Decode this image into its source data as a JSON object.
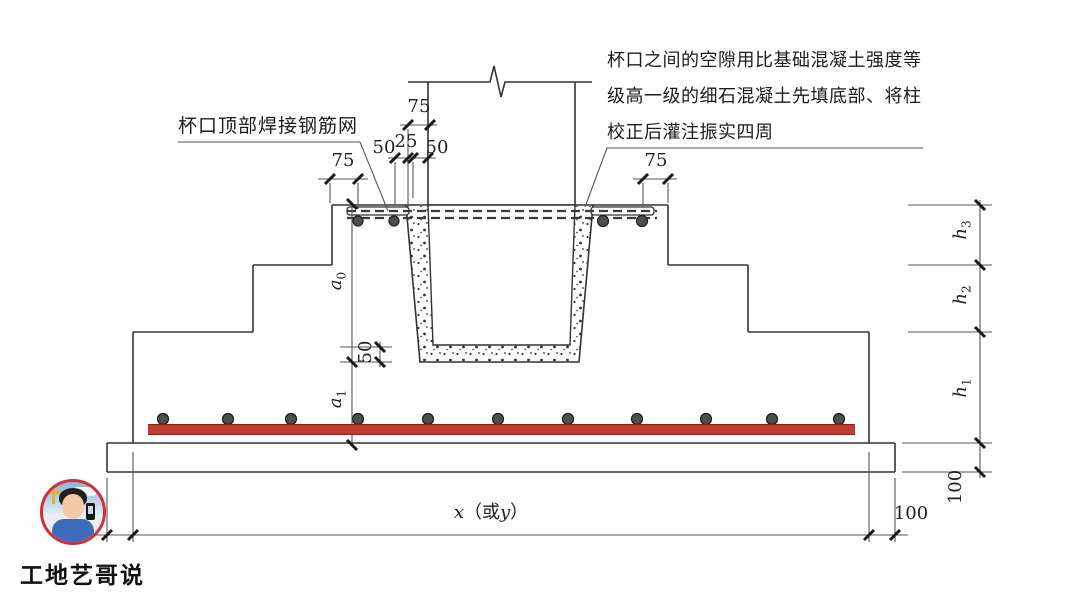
{
  "annotations": {
    "left_label": "杯口顶部焊接钢筋网",
    "right_note_lines": [
      "杯口之间的空隙用比基础混凝土强度等",
      "级高一级的细石混凝土先填底部、将柱",
      "校正后灌注振实四周"
    ]
  },
  "dimensions": {
    "top_left_75": "75",
    "top_right_75": "75",
    "col_75": "75",
    "gap_50_left": "50",
    "gap_25": "25",
    "gap_50_right": "50",
    "bottom_fill_50": "50",
    "a0": {
      "base": "a",
      "sub": "0"
    },
    "a1": {
      "base": "a",
      "sub": "1"
    },
    "h1": {
      "base": "h",
      "sub": "1"
    },
    "h2": {
      "base": "h",
      "sub": "2"
    },
    "h3": {
      "base": "h",
      "sub": "3"
    },
    "bed_100_right": "100",
    "bed_100_bottom": "100",
    "x_or_y": {
      "x": "x",
      "open": "（或",
      "y": "y",
      "close": "）"
    }
  },
  "watermark": {
    "name": "工地艺哥说"
  },
  "colors": {
    "rebar": "#c23b31",
    "rebar_edge": "#8a201a",
    "line": "#333333",
    "dim": "#555555",
    "tick": "#1a1a1a",
    "dot_fill": "#4e4e4e",
    "avatar_ring": "#cf3139"
  }
}
